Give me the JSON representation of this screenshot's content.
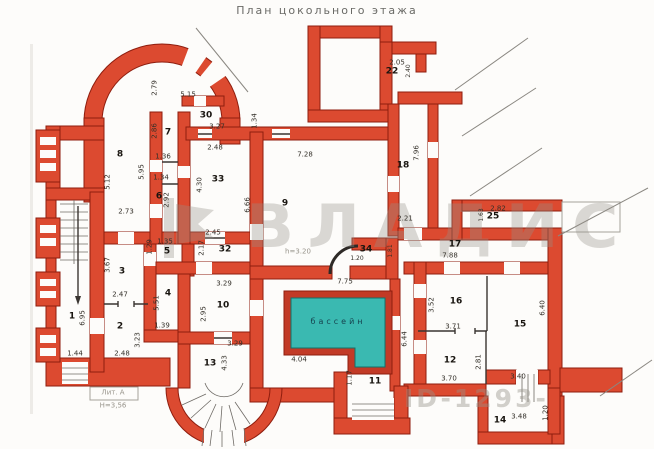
{
  "title": "План цокольного этажа",
  "colors": {
    "wall": "#dc4a30",
    "wall_outline": "#8e1d0e",
    "pool_water": "#3ab9b1",
    "partition_line": "#3a3531",
    "watermark_grey": "#96928a",
    "background": "#fdfcfa"
  },
  "watermark": {
    "brand": "ВЛАДИС",
    "id_text": "ID-1293-"
  },
  "plan": {
    "pool_label": "бассейн",
    "rooms": [
      {
        "number": "1",
        "x": 72,
        "y": 317
      },
      {
        "number": "2",
        "x": 120,
        "y": 327
      },
      {
        "number": "3",
        "x": 122,
        "y": 272
      },
      {
        "number": "4",
        "x": 168,
        "y": 294
      },
      {
        "number": "5",
        "x": 167,
        "y": 252
      },
      {
        "number": "6",
        "x": 159,
        "y": 197
      },
      {
        "number": "7",
        "x": 168,
        "y": 133
      },
      {
        "number": "8",
        "x": 120,
        "y": 155
      },
      {
        "number": "9",
        "x": 285,
        "y": 204
      },
      {
        "number": "10",
        "x": 223,
        "y": 306
      },
      {
        "number": "11",
        "x": 375,
        "y": 382
      },
      {
        "number": "12",
        "x": 450,
        "y": 361
      },
      {
        "number": "13",
        "x": 210,
        "y": 364
      },
      {
        "number": "14",
        "x": 500,
        "y": 421
      },
      {
        "number": "15",
        "x": 520,
        "y": 325
      },
      {
        "number": "16",
        "x": 456,
        "y": 302
      },
      {
        "number": "17",
        "x": 455,
        "y": 245
      },
      {
        "number": "18",
        "x": 403,
        "y": 166
      },
      {
        "number": "22",
        "x": 392,
        "y": 72
      },
      {
        "number": "25",
        "x": 493,
        "y": 217
      },
      {
        "number": "30",
        "x": 206,
        "y": 116
      },
      {
        "number": "32",
        "x": 225,
        "y": 250
      },
      {
        "number": "33",
        "x": 218,
        "y": 180
      },
      {
        "number": "34",
        "x": 366,
        "y": 250
      }
    ],
    "dimensions": [
      {
        "value": "2.79",
        "x": 155,
        "y": 88,
        "vertical": true
      },
      {
        "value": "5.15",
        "x": 188,
        "y": 95
      },
      {
        "value": "3.27",
        "x": 217,
        "y": 127
      },
      {
        "value": "1.34",
        "x": 255,
        "y": 121,
        "vertical": true
      },
      {
        "value": "2.86",
        "x": 155,
        "y": 131,
        "vertical": true
      },
      {
        "value": "1.36",
        "x": 163,
        "y": 157
      },
      {
        "value": "5.95",
        "x": 142,
        "y": 172,
        "vertical": true
      },
      {
        "value": "5.12",
        "x": 108,
        "y": 182,
        "vertical": true
      },
      {
        "value": "1.34",
        "x": 161,
        "y": 178
      },
      {
        "value": "2.92",
        "x": 167,
        "y": 200,
        "vertical": true
      },
      {
        "value": "2.73",
        "x": 126,
        "y": 212
      },
      {
        "value": "2.48",
        "x": 215,
        "y": 148
      },
      {
        "value": "4.30",
        "x": 200,
        "y": 185,
        "vertical": true
      },
      {
        "value": "6.66",
        "x": 248,
        "y": 205,
        "vertical": true
      },
      {
        "value": "2.45",
        "x": 213,
        "y": 233
      },
      {
        "value": "2.17",
        "x": 202,
        "y": 248,
        "vertical": true
      },
      {
        "value": "1.29",
        "x": 150,
        "y": 247,
        "vertical": true
      },
      {
        "value": "1.35",
        "x": 165,
        "y": 242
      },
      {
        "value": "3.67",
        "x": 108,
        "y": 265,
        "vertical": true
      },
      {
        "value": "2.47",
        "x": 120,
        "y": 295
      },
      {
        "value": "5.51",
        "x": 157,
        "y": 303,
        "vertical": true
      },
      {
        "value": "1.39",
        "x": 162,
        "y": 326
      },
      {
        "value": "3.23",
        "x": 138,
        "y": 340,
        "vertical": true
      },
      {
        "value": "2.48",
        "x": 122,
        "y": 354
      },
      {
        "value": "6.95",
        "x": 83,
        "y": 318,
        "vertical": true
      },
      {
        "value": "1.44",
        "x": 75,
        "y": 354
      },
      {
        "value": "3.29",
        "x": 224,
        "y": 284
      },
      {
        "value": "2.95",
        "x": 204,
        "y": 314,
        "vertical": true
      },
      {
        "value": "3.29",
        "x": 235,
        "y": 344
      },
      {
        "value": "4.33",
        "x": 225,
        "y": 363,
        "vertical": true
      },
      {
        "value": "7.28",
        "x": 305,
        "y": 155
      },
      {
        "value": "7.96",
        "x": 417,
        "y": 153,
        "vertical": true
      },
      {
        "value": "2.05",
        "x": 397,
        "y": 63
      },
      {
        "value": "2.40",
        "x": 409,
        "y": 71,
        "vertical": true,
        "small": true
      },
      {
        "value": "2.21",
        "x": 405,
        "y": 219
      },
      {
        "value": "2.82",
        "x": 498,
        "y": 209
      },
      {
        "value": "1.63",
        "x": 482,
        "y": 215,
        "vertical": true,
        "small": true
      },
      {
        "value": "7.88",
        "x": 450,
        "y": 256
      },
      {
        "value": "3.52",
        "x": 432,
        "y": 305,
        "vertical": true
      },
      {
        "value": "3.71",
        "x": 453,
        "y": 327
      },
      {
        "value": "3.70",
        "x": 449,
        "y": 379
      },
      {
        "value": "2.81",
        "x": 479,
        "y": 362,
        "vertical": true
      },
      {
        "value": "6.40",
        "x": 543,
        "y": 308,
        "vertical": true
      },
      {
        "value": "3.40",
        "x": 518,
        "y": 377
      },
      {
        "value": "3.48",
        "x": 519,
        "y": 417
      },
      {
        "value": "1.20",
        "x": 546,
        "y": 413,
        "vertical": true
      },
      {
        "value": "7.75",
        "x": 345,
        "y": 282
      },
      {
        "value": "4.04",
        "x": 299,
        "y": 360
      },
      {
        "value": "6.44",
        "x": 405,
        "y": 339,
        "vertical": true
      },
      {
        "value": "1.17",
        "x": 350,
        "y": 378,
        "vertical": true
      },
      {
        "value": "1.20",
        "x": 357,
        "y": 259,
        "small": true
      },
      {
        "value": "1.81",
        "x": 391,
        "y": 251,
        "vertical": true,
        "small": true
      }
    ],
    "annotations": [
      {
        "text": "h=3.20",
        "x": 298,
        "y": 252,
        "cls": "grey",
        "name": "ceiling-height-note"
      },
      {
        "text": "бассейн",
        "x": 338,
        "y": 322,
        "cls": "pool",
        "name": "pool-label"
      },
      {
        "text": "Лит. А",
        "x": 113,
        "y": 393,
        "cls": "grey",
        "name": "stamp-liter"
      },
      {
        "text": "Н=3,56",
        "x": 113,
        "y": 406,
        "cls": "grey",
        "name": "stamp-height"
      }
    ]
  }
}
